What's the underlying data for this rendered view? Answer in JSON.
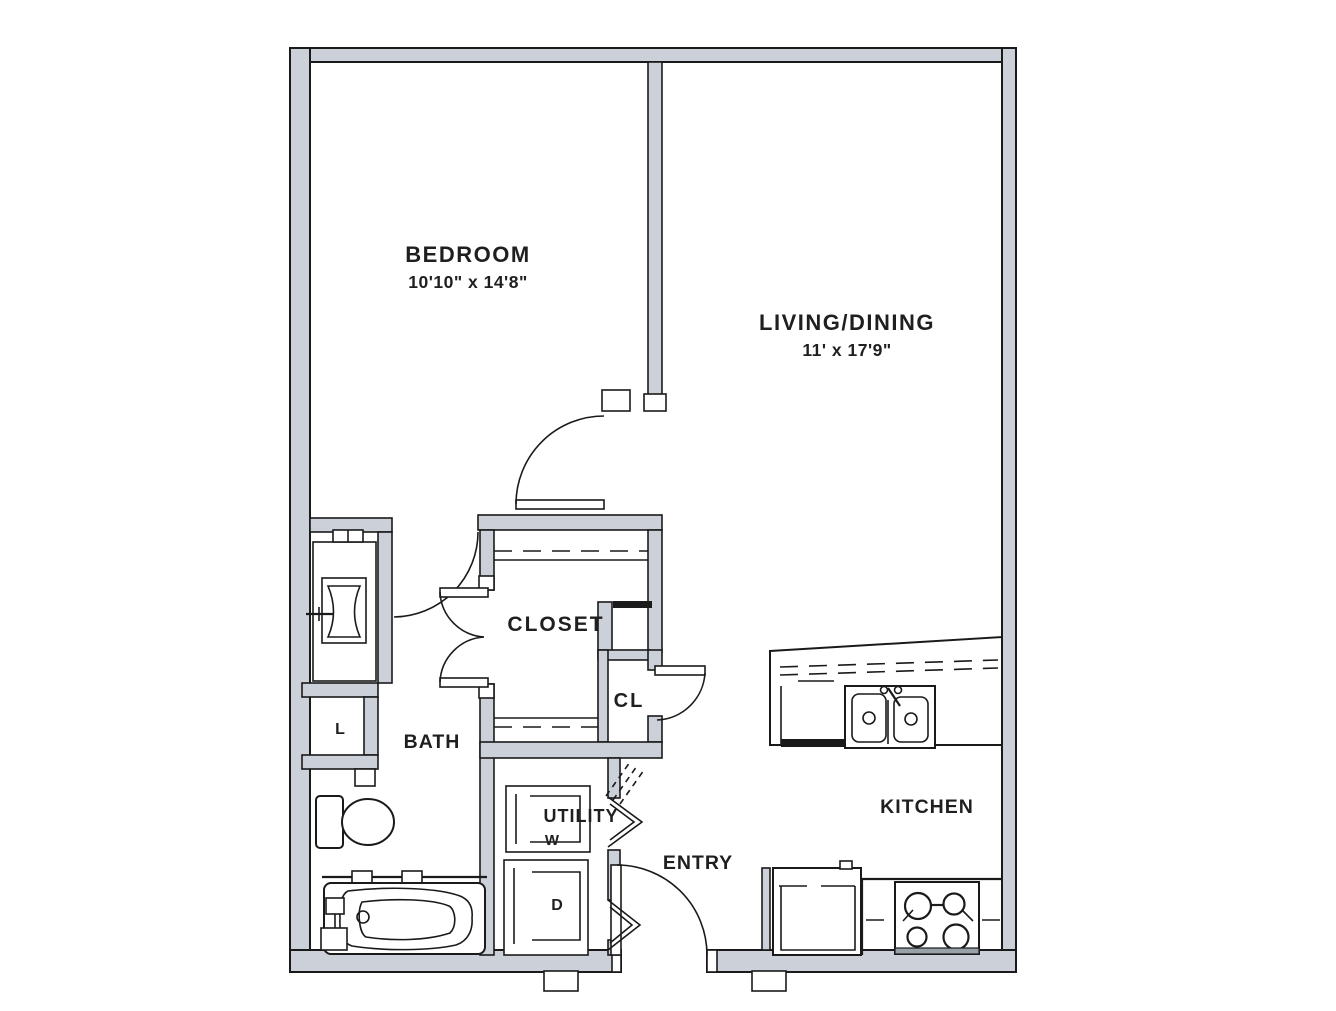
{
  "floorplan": {
    "rooms": {
      "bedroom": {
        "label": "BEDROOM",
        "dimensions": "10'10\" x 14'8\""
      },
      "living_dining": {
        "label": "LIVING/DINING",
        "dimensions": "11' x 17'9\""
      },
      "closet": {
        "label": "CLOSET"
      },
      "closet_small": {
        "label": "CL"
      },
      "bath": {
        "label": "BATH"
      },
      "linen_closet": {
        "label": "L"
      },
      "utility": {
        "label": "UTILITY"
      },
      "entry": {
        "label": "ENTRY"
      },
      "kitchen": {
        "label": "KITCHEN"
      }
    },
    "appliances": {
      "washer": "W",
      "dryer": "D"
    },
    "colors": {
      "wall_fill": "#cbd0d9",
      "line": "#1a1a1a",
      "background": "#ffffff",
      "text": "#1f1f1f"
    }
  }
}
